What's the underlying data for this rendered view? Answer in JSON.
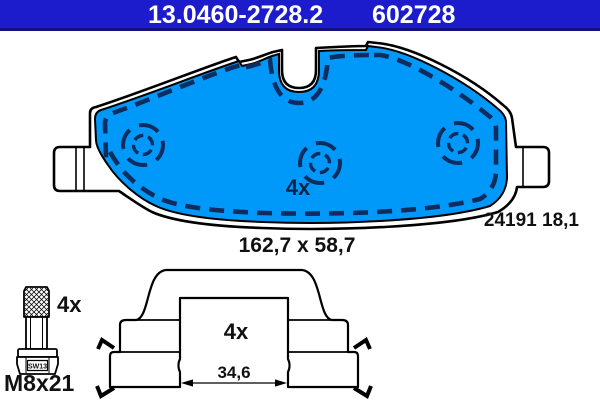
{
  "header": {
    "background": "#1c1ccd",
    "part_number": "13.0460-2728.2",
    "reference": "602728"
  },
  "pad": {
    "fill_color": "#0099fa",
    "marking_color": "#0d2d5e",
    "quantity_label": "4x",
    "code_and_thickness": "24191 18,1",
    "dimensions": "162,7 x 58,7"
  },
  "bolt": {
    "quantity_label": "4x",
    "wrench_size": "SW13",
    "thread_spec": "M8x21"
  },
  "shim": {
    "quantity_label": "4x",
    "inner_width": "34,6"
  }
}
